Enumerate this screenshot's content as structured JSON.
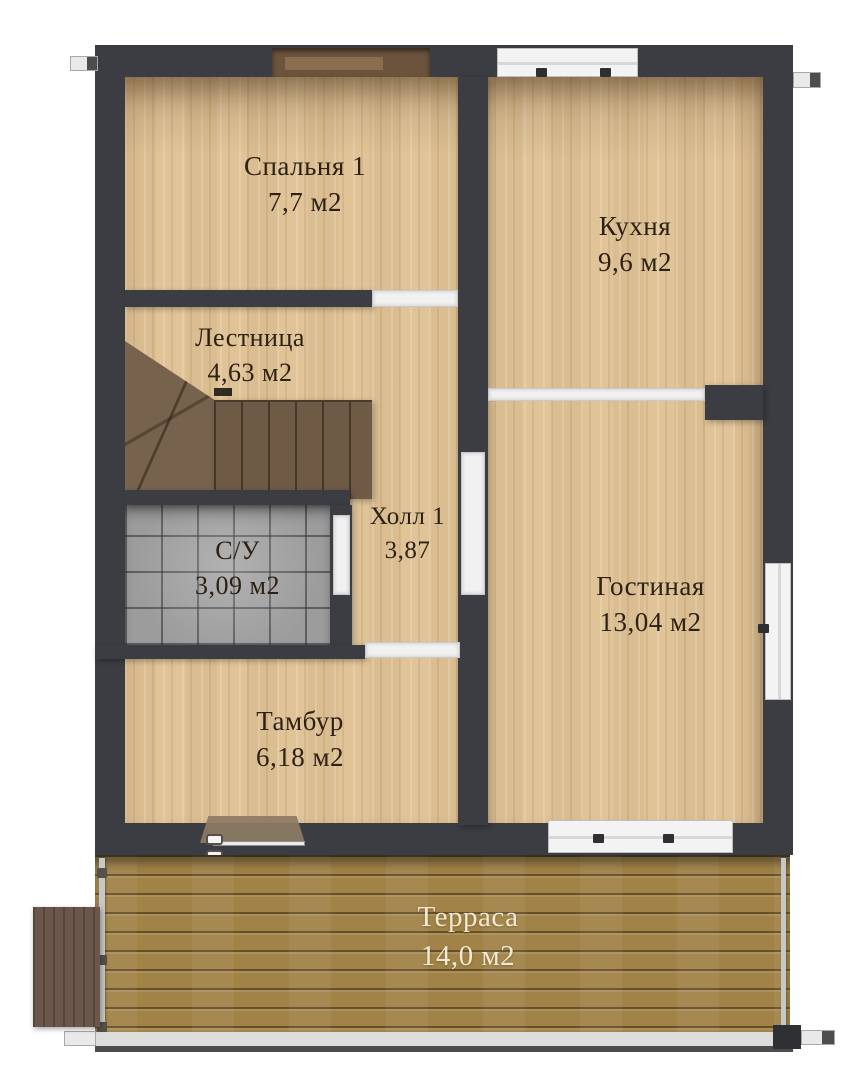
{
  "plan": {
    "type": "floor-plan",
    "language": "ru",
    "rooms": [
      {
        "name": "Спальня 1",
        "area": "7,7 м2"
      },
      {
        "name": "Кухня",
        "area": "9,6 м2"
      },
      {
        "name": "Лестница",
        "area": "4,63 м2"
      },
      {
        "name": "Холл 1",
        "area": "3,87"
      },
      {
        "name": "С/У",
        "area": "3,09 м2"
      },
      {
        "name": "Гостиная",
        "area": "13,04 м2"
      },
      {
        "name": "Тамбур",
        "area": "6,18 м2"
      },
      {
        "name": "Терраса",
        "area": "14,0 м2"
      }
    ],
    "colors": {
      "wall": "#3b3d43",
      "parquet": "#e0c498",
      "tile": "#9c9c9c",
      "deck": "#a18347",
      "stairs": "#6f5a46",
      "porch": "#6a564a",
      "opening": "#f1f1f1",
      "label_text": "#2d2113",
      "terrace_text": "#f2e9d4",
      "background": "#ffffff"
    }
  }
}
